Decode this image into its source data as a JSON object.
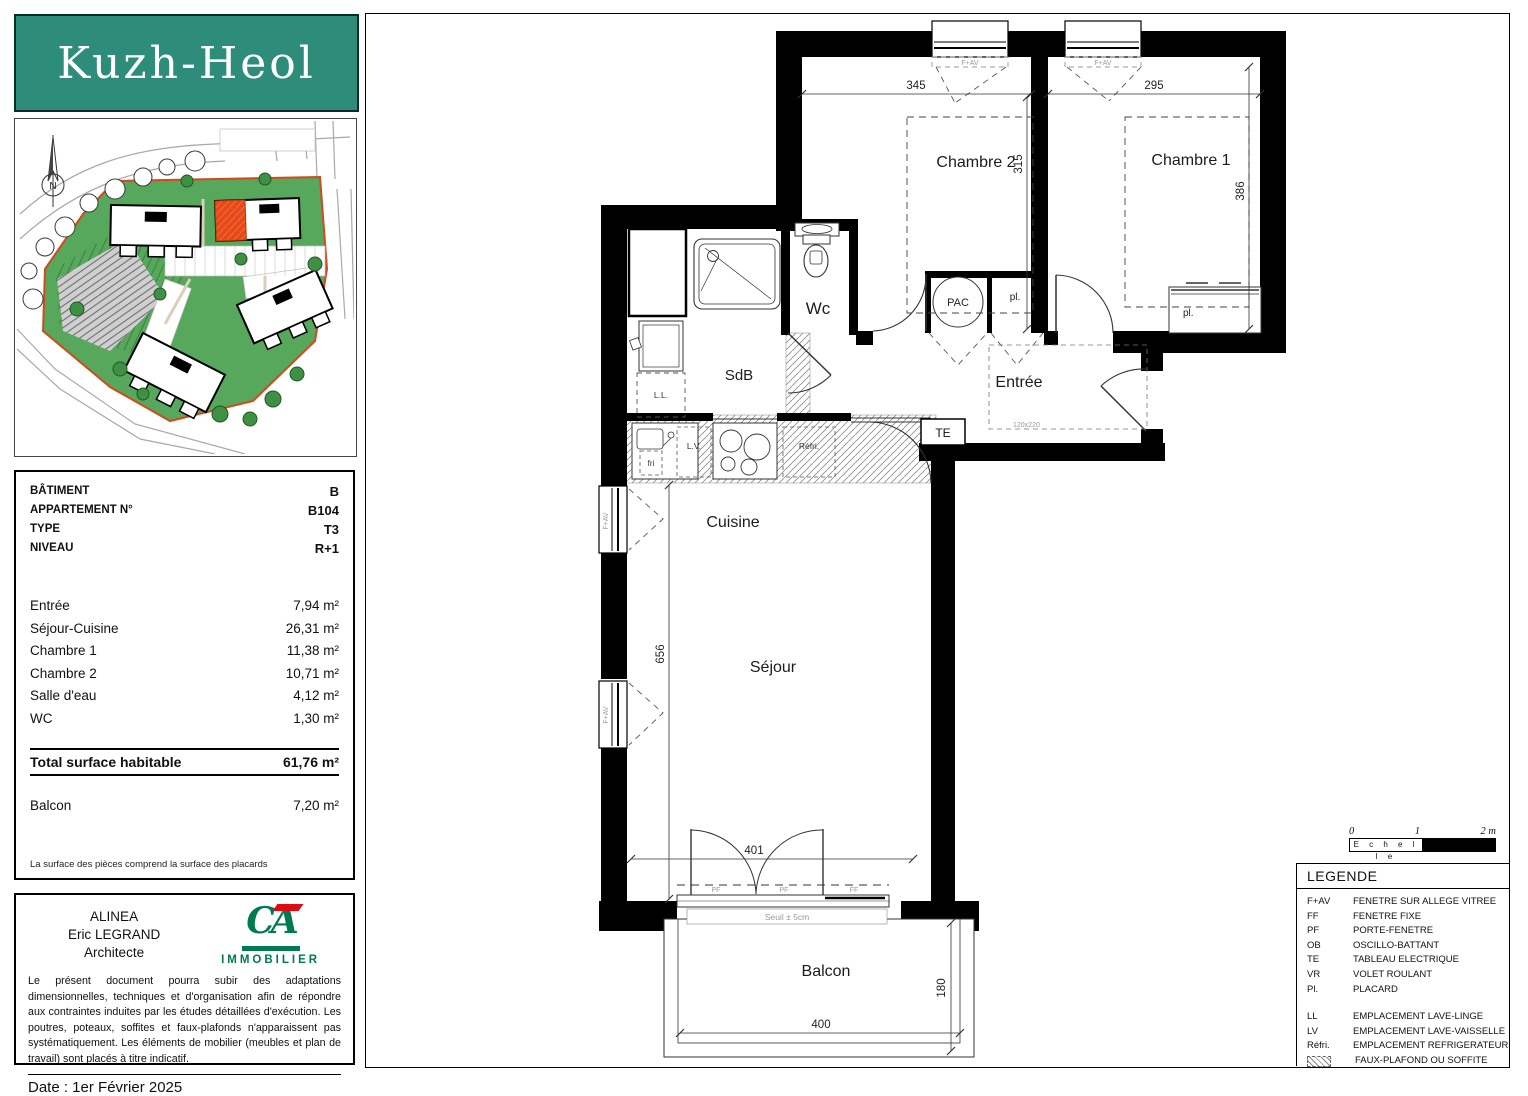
{
  "project": {
    "name": "Kuzh-Heol"
  },
  "siteplan": {
    "north": "N"
  },
  "info": {
    "header_rows": [
      {
        "label": "BÂTIMENT",
        "value": "B"
      },
      {
        "label": "APPARTEMENT N°",
        "value": "B104"
      },
      {
        "label": "TYPE",
        "value": "T3"
      },
      {
        "label": "NIVEAU",
        "value": "R+1"
      }
    ],
    "area_rows": [
      {
        "label": "Entrée",
        "value": "7,94 m²"
      },
      {
        "label": "Séjour-Cuisine",
        "value": "26,31 m²"
      },
      {
        "label": "Chambre 1",
        "value": "11,38 m²"
      },
      {
        "label": "Chambre 2",
        "value": "10,71 m²"
      },
      {
        "label": "Salle d'eau",
        "value": "4,12 m²"
      },
      {
        "label": "WC",
        "value": "1,30 m²"
      }
    ],
    "total_row": {
      "label": "Total surface habitable",
      "value": "61,76 m²"
    },
    "balcony_row": {
      "label": "Balcon",
      "value": "7,20 m²"
    },
    "note": "La surface des pièces comprend la surface des placards"
  },
  "architect": {
    "line1": "ALINEA",
    "line2": "Eric LEGRAND",
    "line3": "Architecte",
    "logo_brand": "CA",
    "logo_sub": "IMMOBILIER",
    "disclaimer": "Le présent document pourra subir des adaptations dimensionnelles, techniques et d'organisation afin de répondre aux contraintes induites par les études détaillées d'exécution. Les poutres, poteaux, soffites et faux-plafonds n'apparaissent pas systématiquement. Les éléments de mobilier (meubles et plan de travail) sont placés à titre indicatif.",
    "date": "Date : 1er Février 2025"
  },
  "plan": {
    "rooms": {
      "chambre2": "Chambre 2",
      "chambre1": "Chambre 1",
      "wc": "Wc",
      "sdb": "SdB",
      "entree": "Entrée",
      "cuisine": "Cuisine",
      "sejour": "Séjour",
      "balcon": "Balcon"
    },
    "features": {
      "pac": "PAC",
      "pl": "pl.",
      "te": "TE",
      "ll": "L.L.",
      "lv": "L.V.",
      "refri": "Réfri.",
      "fri": "fri",
      "seuil": "Seuil ± 5cm",
      "door_size": "120x220"
    },
    "wins": {
      "fav": "F+AV",
      "pf": "PF",
      "ff": "FF"
    },
    "dims": {
      "ch2_w": "345",
      "ch1_w": "295",
      "ch2_h": "315",
      "ch1_h": "386",
      "sej_h": "656",
      "sej_w": "401",
      "bal_w": "400",
      "bal_d": "180"
    }
  },
  "legend": {
    "title": "LEGENDE",
    "items": [
      {
        "abbr": "F+AV",
        "text": "FENETRE SUR ALLEGE VITREE"
      },
      {
        "abbr": "FF",
        "text": "FENETRE FIXE"
      },
      {
        "abbr": "PF",
        "text": "PORTE-FENETRE"
      },
      {
        "abbr": "OB",
        "text": "OSCILLO-BATTANT"
      },
      {
        "abbr": "TE",
        "text": "TABLEAU ELECTRIQUE"
      },
      {
        "abbr": "VR",
        "text": "VOLET ROULANT"
      },
      {
        "abbr": "Pl.",
        "text": "PLACARD"
      },
      {
        "abbr": "LL",
        "text": "EMPLACEMENT LAVE-LINGE"
      },
      {
        "abbr": "LV",
        "text": "EMPLACEMENT LAVE-VAISSELLE"
      },
      {
        "abbr": "Réfri.",
        "text": "EMPLACEMENT REFRIGERATEUR"
      },
      {
        "abbr": "",
        "text": "FAUX-PLAFOND OU SOFFITE"
      }
    ]
  },
  "scale": {
    "t0": "0",
    "t1": "1",
    "t2": "2 m",
    "label": "E c h e l l e"
  },
  "colors": {
    "banner_teal": "#2e8c7a",
    "ca_green": "#007a53",
    "ca_red": "#e30613",
    "site_green": "#57a75c",
    "site_boundary": "#d2491d",
    "unit_red": "#e64a19"
  }
}
